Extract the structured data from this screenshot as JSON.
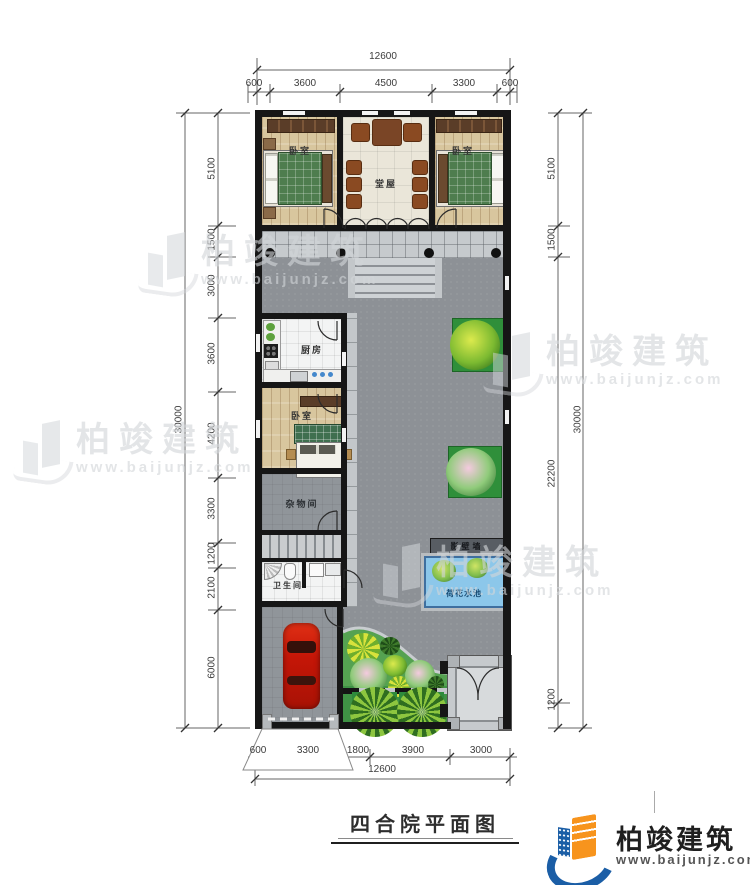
{
  "meta": {
    "caption": "四合院平面图"
  },
  "watermark": {
    "brand": "柏竣建筑",
    "url": "www.baijunjz.com"
  },
  "logo": {
    "brand": "柏竣建筑",
    "url": "www.baijunjz.com"
  },
  "dims": {
    "top": {
      "total": "12600",
      "segments": [
        "600",
        "3600",
        "4500",
        "3300",
        "600"
      ]
    },
    "bottom": {
      "total": "12600",
      "segments": [
        "600",
        "3300",
        "1800",
        "3900",
        "3000"
      ]
    },
    "left": {
      "total": "30000",
      "segments": [
        "5100",
        "1500",
        "3000",
        "3600",
        "4200",
        "3300",
        "1200",
        "2100",
        "6000"
      ]
    },
    "right": {
      "total": "30000",
      "segments": [
        "5100",
        "1500",
        "22200",
        "1200"
      ]
    }
  },
  "rooms": {
    "bedroom_top_left": "卧室",
    "hall": "堂屋",
    "bedroom_top_right": "卧室",
    "kitchen": "厨房",
    "bedroom_mid": "卧室",
    "storage": "杂物间",
    "bathroom": "卫生间"
  },
  "site": {
    "screen_wall": "影壁墙",
    "lotus_pond": "荷花水池"
  },
  "colors": {
    "wall": "#161616",
    "courtyard": "#8d9196",
    "garden": "#57a757",
    "pond": "#8cc7ea",
    "car": "#c51607",
    "accent_orange": "#f7941d",
    "accent_blue": "#1b5ea6"
  }
}
